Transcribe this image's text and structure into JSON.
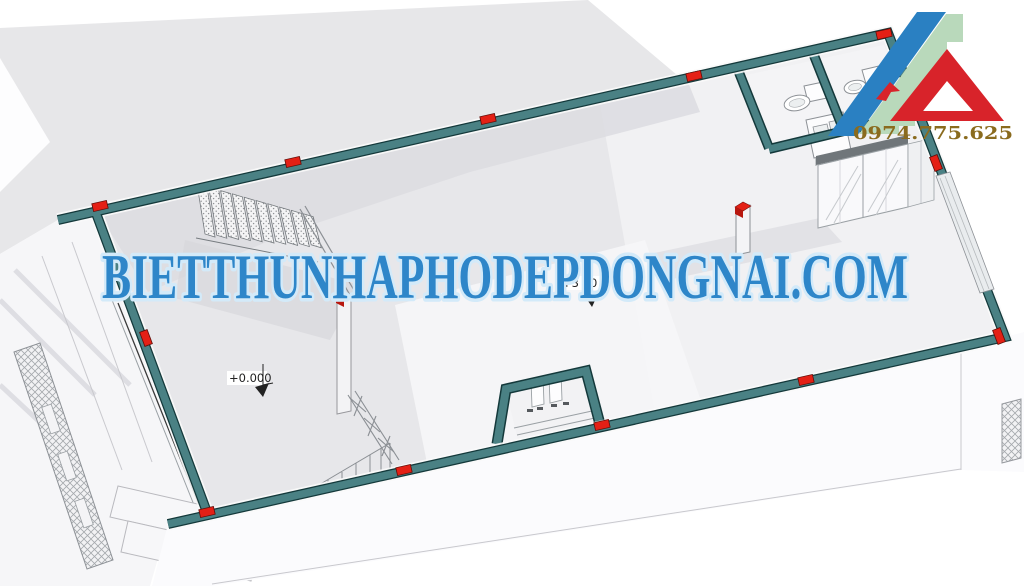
{
  "scene": {
    "type": "3d-floor-plan-render",
    "watermark": {
      "text": "BIETTHUNHAPHODEPDONGNAI.COM",
      "color": "#2e86c9",
      "halo_color": "#d3eaf9"
    },
    "logo": {
      "phone": "0974.775.625",
      "phone_color": "#8a6b1e",
      "stripe_blue": "#2a80c2",
      "steps_green": "#b9d9bb",
      "triangle_red": "#d8232a"
    },
    "annotations": {
      "level_ground": "+0.000",
      "level_upper_prefix": "+3",
      "level_upper_suffix": "0"
    },
    "palette": {
      "wall_teal": "#4a8184",
      "wall_edge": "#14393b",
      "marker_red": "#e42015",
      "floor": "#e7e7ea",
      "backdrop": "#e7e7e9"
    }
  }
}
